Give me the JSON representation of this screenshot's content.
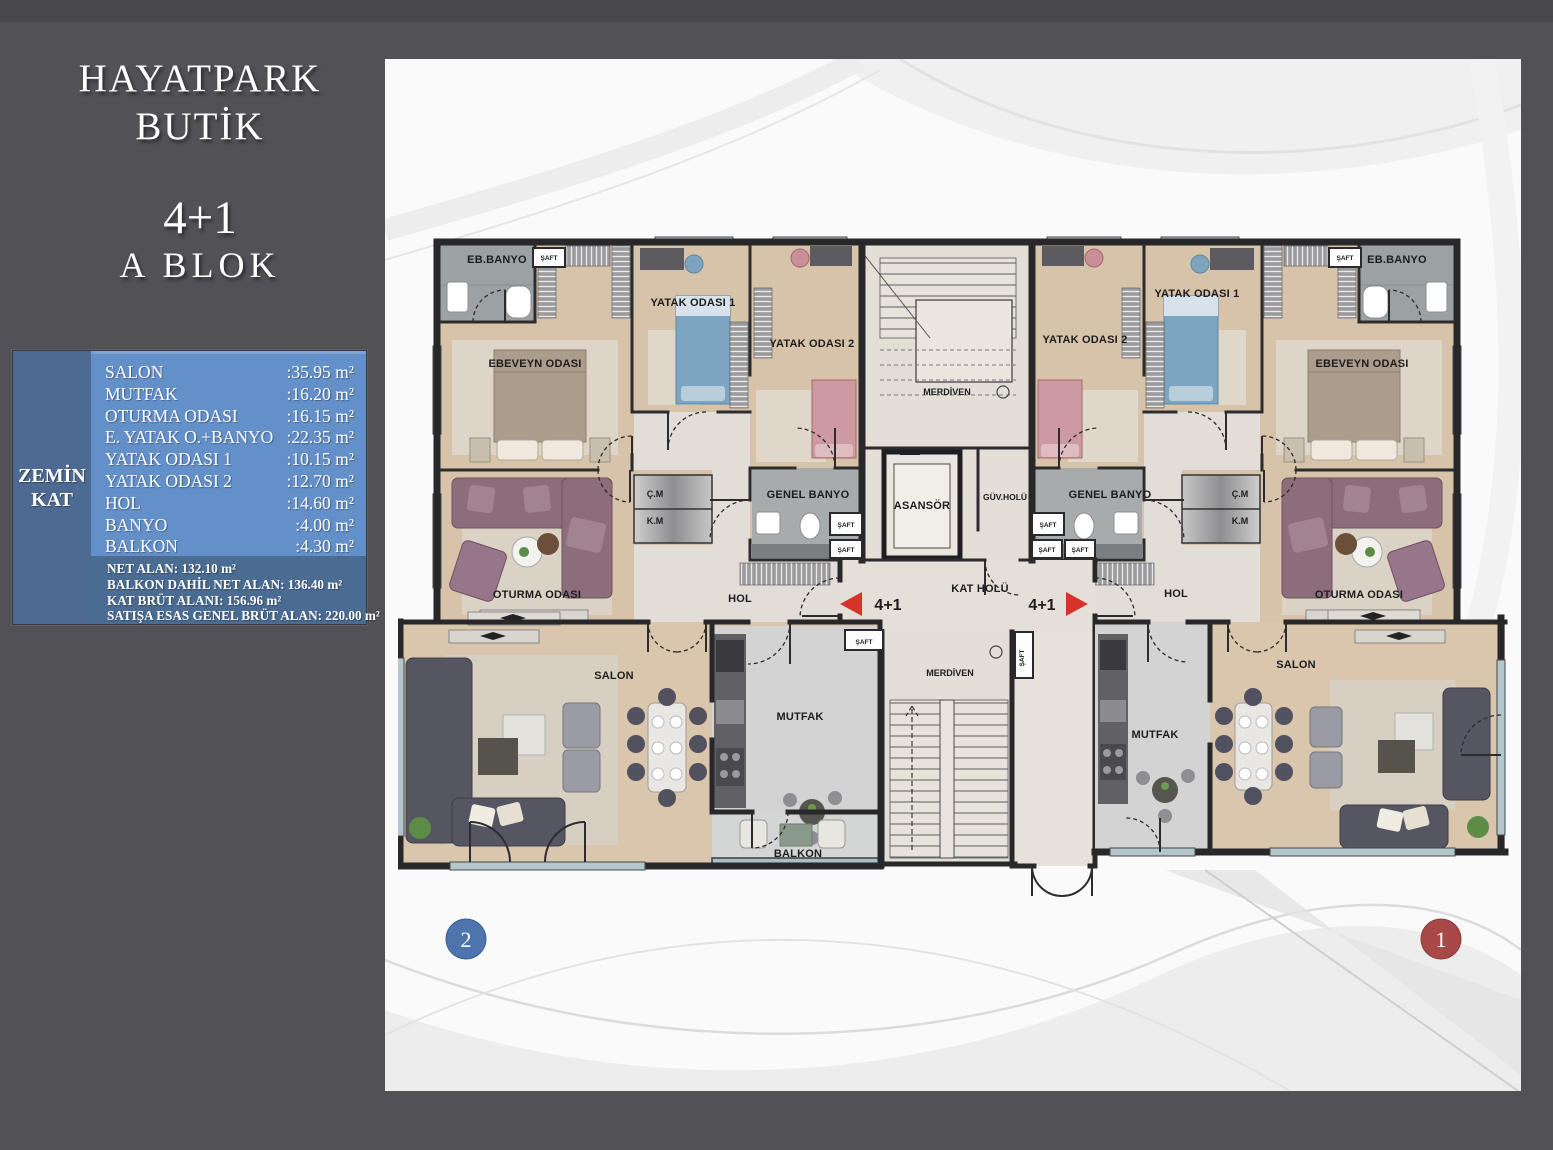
{
  "header": {
    "title_line1": "HAYATPARK",
    "title_line2": "BUTİK",
    "unit_type": "4+1",
    "block": "A BLOK"
  },
  "floor_panel": {
    "floor_line1": "ZEMİN",
    "floor_line2": "KAT",
    "rooms": [
      {
        "label": "SALON",
        "value": ":35.95 m²"
      },
      {
        "label": "MUTFAK",
        "value": ":16.20 m²"
      },
      {
        "label": "OTURMA ODASI",
        "value": ":16.15 m²"
      },
      {
        "label": "E. YATAK O.+BANYO",
        "value": ":22.35 m²"
      },
      {
        "label": "YATAK ODASI 1",
        "value": ":10.15 m²"
      },
      {
        "label": "YATAK ODASI 2",
        "value": ":12.70 m²"
      },
      {
        "label": "HOL",
        "value": ":14.60 m²"
      },
      {
        "label": "BANYO",
        "value": ":4.00 m²"
      },
      {
        "label": "BALKON",
        "value": ":4.30 m²"
      }
    ],
    "summary": [
      "NET ALAN: 132.10 m²",
      "BALKON DAHİL NET ALAN: 136.40 m²",
      "KAT BRÜT ALANI: 156.96 m²",
      "SATIŞA ESAS GENEL BRÜT ALAN: 220.00 m²"
    ]
  },
  "plan": {
    "rooms": {
      "eb_banyo": "EB.BANYO",
      "saft": "ŞAFT",
      "ebeveyn_odasi": "EBEVEYN ODASI",
      "yatak_odasi_1": "YATAK ODASI 1",
      "yatak_odasi_2": "YATAK ODASI 2",
      "genel_banyo": "GENEL BANYO",
      "cm": "Ç.M",
      "km": "K.M",
      "hol": "HOL",
      "oturma_odasi": "OTURMA ODASI",
      "salon": "SALON",
      "mutfak": "MUTFAK",
      "balkon": "BALKON",
      "merdiven": "MERDİVEN",
      "asansor": "ASANSÖR",
      "guv_holu": "GÜV.HOLÜ",
      "kat_holu": "KAT HOLÜ",
      "unit_tag": "4+1"
    },
    "markers": {
      "unit2": "2",
      "unit1": "1"
    }
  },
  "colors": {
    "accent_red": "#d6342b",
    "marker_blue": "#4d74ad",
    "marker_red": "#a84848",
    "panel_blue": "#6490ca",
    "panel_slate": "#4d6b92",
    "sidebar_gray": "#525156"
  }
}
